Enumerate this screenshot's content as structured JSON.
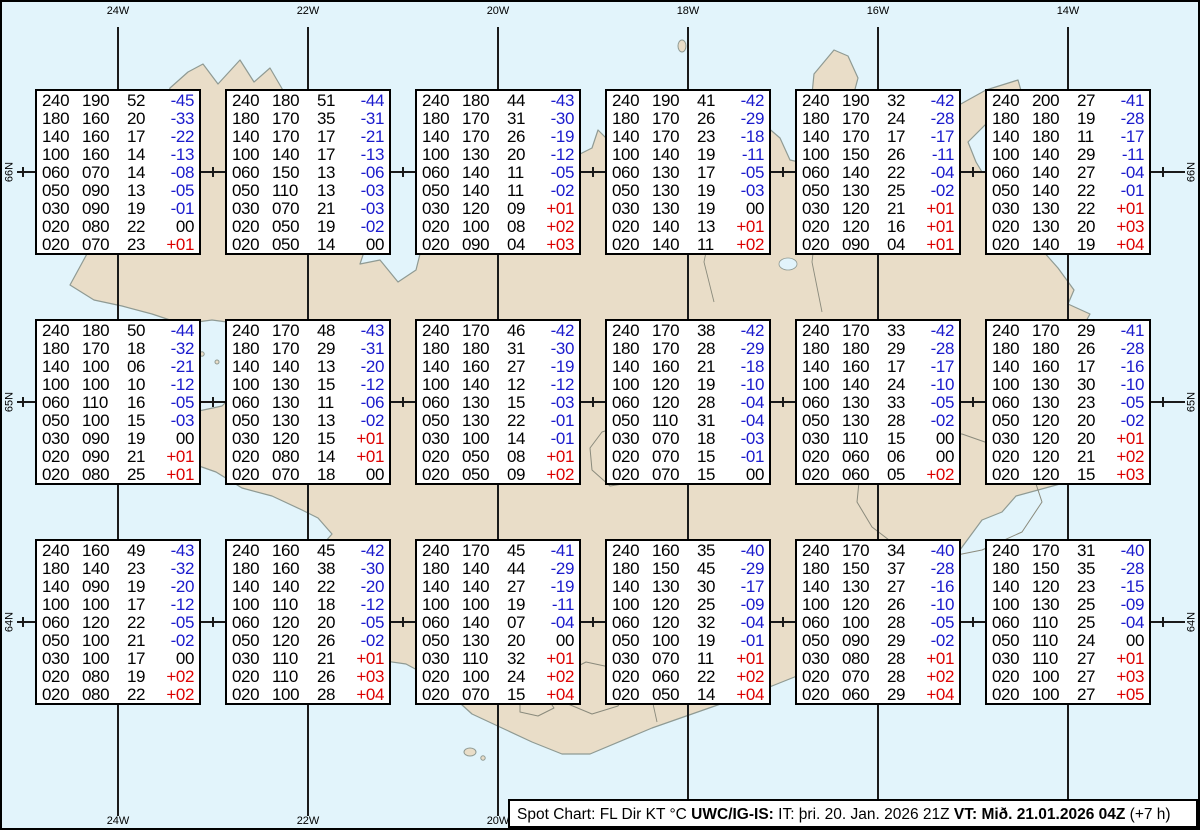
{
  "colors": {
    "ocean": "#E2F4FB",
    "land": "#E9DDC8",
    "coast": "#8F9A93",
    "grid_line": "#1A1A1A",
    "temp_negative": "#1A1ACD",
    "temp_positive": "#DD0000",
    "temp_zero": "#000000"
  },
  "map": {
    "lon_labels_top": [
      "24W",
      "22W",
      "20W",
      "18W",
      "16W",
      "14W"
    ],
    "lon_labels_bottom": [
      "24W",
      "22W",
      "20W"
    ],
    "lat_labels_left": [
      "66N",
      "65N",
      "64N"
    ],
    "lat_labels_right": [
      "66N",
      "65N",
      "64N"
    ]
  },
  "footer": {
    "segments": [
      {
        "text": "Spot Chart: FL Dir KT °C ",
        "bold": false
      },
      {
        "text": "UWC/IG-IS:",
        "bold": true
      },
      {
        "text": " IT: þri. 20. Jan. 2026 21Z ",
        "bold": false
      },
      {
        "text": "VT: Mið. 21.01.2026 04Z",
        "bold": true
      },
      {
        "text": " (+7 h)",
        "bold": false
      }
    ]
  },
  "chart_data": {
    "type": "table",
    "title": "Spot Chart: FL Dir KT °C",
    "columns": [
      "FL",
      "Dir",
      "KT",
      "°C"
    ],
    "grid_lons": [
      "24W",
      "22W",
      "20W",
      "18W",
      "16W",
      "14W"
    ],
    "grid_lats": [
      "66N",
      "65N",
      "64N"
    ],
    "stations": [
      {
        "lat": "66N",
        "lon": "24W",
        "levels": [
          [
            "240",
            "190",
            "52",
            "-45"
          ],
          [
            "180",
            "160",
            "20",
            "-33"
          ],
          [
            "140",
            "160",
            "17",
            "-22"
          ],
          [
            "100",
            "160",
            "14",
            "-13"
          ],
          [
            "060",
            "070",
            "14",
            "-08"
          ],
          [
            "050",
            "090",
            "13",
            "-05"
          ],
          [
            "030",
            "090",
            "19",
            "-01"
          ],
          [
            "020",
            "080",
            "22",
            "00"
          ],
          [
            "020",
            "070",
            "23",
            "+01"
          ]
        ]
      },
      {
        "lat": "66N",
        "lon": "22W",
        "levels": [
          [
            "240",
            "180",
            "51",
            "-44"
          ],
          [
            "180",
            "170",
            "35",
            "-31"
          ],
          [
            "140",
            "170",
            "17",
            "-21"
          ],
          [
            "100",
            "140",
            "17",
            "-13"
          ],
          [
            "060",
            "150",
            "13",
            "-06"
          ],
          [
            "050",
            "110",
            "13",
            "-03"
          ],
          [
            "030",
            "070",
            "21",
            "-03"
          ],
          [
            "020",
            "050",
            "19",
            "-02"
          ],
          [
            "020",
            "050",
            "14",
            "00"
          ]
        ]
      },
      {
        "lat": "66N",
        "lon": "20W",
        "levels": [
          [
            "240",
            "180",
            "44",
            "-43"
          ],
          [
            "180",
            "170",
            "31",
            "-30"
          ],
          [
            "140",
            "170",
            "26",
            "-19"
          ],
          [
            "100",
            "130",
            "20",
            "-12"
          ],
          [
            "060",
            "140",
            "11",
            "-05"
          ],
          [
            "050",
            "140",
            "11",
            "-02"
          ],
          [
            "030",
            "120",
            "09",
            "+01"
          ],
          [
            "020",
            "100",
            "08",
            "+02"
          ],
          [
            "020",
            "090",
            "04",
            "+03"
          ]
        ]
      },
      {
        "lat": "66N",
        "lon": "18W",
        "levels": [
          [
            "240",
            "190",
            "41",
            "-42"
          ],
          [
            "180",
            "170",
            "26",
            "-29"
          ],
          [
            "140",
            "170",
            "23",
            "-18"
          ],
          [
            "100",
            "140",
            "19",
            "-11"
          ],
          [
            "060",
            "130",
            "17",
            "-05"
          ],
          [
            "050",
            "130",
            "19",
            "-03"
          ],
          [
            "030",
            "130",
            "19",
            "00"
          ],
          [
            "020",
            "140",
            "13",
            "+01"
          ],
          [
            "020",
            "140",
            "11",
            "+02"
          ]
        ]
      },
      {
        "lat": "66N",
        "lon": "16W",
        "levels": [
          [
            "240",
            "190",
            "32",
            "-42"
          ],
          [
            "180",
            "170",
            "24",
            "-28"
          ],
          [
            "140",
            "170",
            "17",
            "-17"
          ],
          [
            "100",
            "150",
            "26",
            "-11"
          ],
          [
            "060",
            "140",
            "22",
            "-04"
          ],
          [
            "050",
            "130",
            "25",
            "-02"
          ],
          [
            "030",
            "120",
            "21",
            "+01"
          ],
          [
            "020",
            "120",
            "16",
            "+01"
          ],
          [
            "020",
            "090",
            "04",
            "+01"
          ]
        ]
      },
      {
        "lat": "66N",
        "lon": "14W",
        "levels": [
          [
            "240",
            "200",
            "27",
            "-41"
          ],
          [
            "180",
            "180",
            "19",
            "-28"
          ],
          [
            "140",
            "180",
            "11",
            "-17"
          ],
          [
            "100",
            "140",
            "29",
            "-11"
          ],
          [
            "060",
            "140",
            "27",
            "-04"
          ],
          [
            "050",
            "140",
            "22",
            "-01"
          ],
          [
            "030",
            "130",
            "22",
            "+01"
          ],
          [
            "020",
            "130",
            "20",
            "+03"
          ],
          [
            "020",
            "140",
            "19",
            "+04"
          ]
        ]
      },
      {
        "lat": "65N",
        "lon": "24W",
        "levels": [
          [
            "240",
            "180",
            "50",
            "-44"
          ],
          [
            "180",
            "170",
            "18",
            "-32"
          ],
          [
            "140",
            "100",
            "06",
            "-21"
          ],
          [
            "100",
            "100",
            "10",
            "-12"
          ],
          [
            "060",
            "110",
            "16",
            "-05"
          ],
          [
            "050",
            "100",
            "15",
            "-03"
          ],
          [
            "030",
            "090",
            "19",
            "00"
          ],
          [
            "020",
            "090",
            "21",
            "+01"
          ],
          [
            "020",
            "080",
            "25",
            "+01"
          ]
        ]
      },
      {
        "lat": "65N",
        "lon": "22W",
        "levels": [
          [
            "240",
            "170",
            "48",
            "-43"
          ],
          [
            "180",
            "170",
            "29",
            "-31"
          ],
          [
            "140",
            "140",
            "13",
            "-20"
          ],
          [
            "100",
            "130",
            "15",
            "-12"
          ],
          [
            "060",
            "130",
            "11",
            "-06"
          ],
          [
            "050",
            "130",
            "13",
            "-02"
          ],
          [
            "030",
            "120",
            "15",
            "+01"
          ],
          [
            "020",
            "080",
            "14",
            "+01"
          ],
          [
            "020",
            "070",
            "18",
            "00"
          ]
        ]
      },
      {
        "lat": "65N",
        "lon": "20W",
        "levels": [
          [
            "240",
            "170",
            "46",
            "-42"
          ],
          [
            "180",
            "180",
            "31",
            "-30"
          ],
          [
            "140",
            "160",
            "27",
            "-19"
          ],
          [
            "100",
            "140",
            "12",
            "-12"
          ],
          [
            "060",
            "130",
            "15",
            "-03"
          ],
          [
            "050",
            "130",
            "22",
            "-01"
          ],
          [
            "030",
            "100",
            "14",
            "-01"
          ],
          [
            "020",
            "050",
            "08",
            "+01"
          ],
          [
            "020",
            "050",
            "09",
            "+02"
          ]
        ]
      },
      {
        "lat": "65N",
        "lon": "18W",
        "levels": [
          [
            "240",
            "170",
            "38",
            "-42"
          ],
          [
            "180",
            "170",
            "28",
            "-29"
          ],
          [
            "140",
            "160",
            "21",
            "-18"
          ],
          [
            "100",
            "120",
            "19",
            "-10"
          ],
          [
            "060",
            "120",
            "28",
            "-04"
          ],
          [
            "050",
            "110",
            "31",
            "-04"
          ],
          [
            "030",
            "070",
            "18",
            "-03"
          ],
          [
            "020",
            "070",
            "15",
            "-01"
          ],
          [
            "020",
            "070",
            "15",
            "00"
          ]
        ]
      },
      {
        "lat": "65N",
        "lon": "16W",
        "levels": [
          [
            "240",
            "170",
            "33",
            "-42"
          ],
          [
            "180",
            "180",
            "29",
            "-28"
          ],
          [
            "140",
            "160",
            "17",
            "-17"
          ],
          [
            "100",
            "140",
            "24",
            "-10"
          ],
          [
            "060",
            "130",
            "33",
            "-05"
          ],
          [
            "050",
            "130",
            "28",
            "-02"
          ],
          [
            "030",
            "110",
            "15",
            "00"
          ],
          [
            "020",
            "060",
            "06",
            "00"
          ],
          [
            "020",
            "060",
            "05",
            "+02"
          ]
        ]
      },
      {
        "lat": "65N",
        "lon": "14W",
        "levels": [
          [
            "240",
            "170",
            "29",
            "-41"
          ],
          [
            "180",
            "180",
            "26",
            "-28"
          ],
          [
            "140",
            "160",
            "17",
            "-16"
          ],
          [
            "100",
            "130",
            "30",
            "-10"
          ],
          [
            "060",
            "130",
            "23",
            "-05"
          ],
          [
            "050",
            "120",
            "20",
            "-02"
          ],
          [
            "030",
            "120",
            "20",
            "+01"
          ],
          [
            "020",
            "120",
            "21",
            "+02"
          ],
          [
            "020",
            "120",
            "15",
            "+03"
          ]
        ]
      },
      {
        "lat": "64N",
        "lon": "24W",
        "levels": [
          [
            "240",
            "160",
            "49",
            "-43"
          ],
          [
            "180",
            "140",
            "23",
            "-32"
          ],
          [
            "140",
            "090",
            "19",
            "-20"
          ],
          [
            "100",
            "100",
            "17",
            "-12"
          ],
          [
            "060",
            "120",
            "22",
            "-05"
          ],
          [
            "050",
            "100",
            "21",
            "-02"
          ],
          [
            "030",
            "100",
            "17",
            "00"
          ],
          [
            "020",
            "080",
            "19",
            "+02"
          ],
          [
            "020",
            "080",
            "22",
            "+02"
          ]
        ]
      },
      {
        "lat": "64N",
        "lon": "22W",
        "levels": [
          [
            "240",
            "160",
            "45",
            "-42"
          ],
          [
            "180",
            "160",
            "38",
            "-30"
          ],
          [
            "140",
            "140",
            "22",
            "-20"
          ],
          [
            "100",
            "110",
            "18",
            "-12"
          ],
          [
            "060",
            "120",
            "20",
            "-05"
          ],
          [
            "050",
            "120",
            "26",
            "-02"
          ],
          [
            "030",
            "110",
            "21",
            "+01"
          ],
          [
            "020",
            "110",
            "26",
            "+03"
          ],
          [
            "020",
            "100",
            "28",
            "+04"
          ]
        ]
      },
      {
        "lat": "64N",
        "lon": "20W",
        "levels": [
          [
            "240",
            "170",
            "45",
            "-41"
          ],
          [
            "180",
            "140",
            "44",
            "-29"
          ],
          [
            "140",
            "140",
            "27",
            "-19"
          ],
          [
            "100",
            "100",
            "19",
            "-11"
          ],
          [
            "060",
            "140",
            "07",
            "-04"
          ],
          [
            "050",
            "130",
            "20",
            "00"
          ],
          [
            "030",
            "110",
            "32",
            "+01"
          ],
          [
            "020",
            "100",
            "24",
            "+02"
          ],
          [
            "020",
            "070",
            "15",
            "+04"
          ]
        ]
      },
      {
        "lat": "64N",
        "lon": "18W",
        "levels": [
          [
            "240",
            "160",
            "35",
            "-40"
          ],
          [
            "180",
            "150",
            "45",
            "-29"
          ],
          [
            "140",
            "130",
            "30",
            "-17"
          ],
          [
            "100",
            "120",
            "25",
            "-09"
          ],
          [
            "060",
            "120",
            "32",
            "-04"
          ],
          [
            "050",
            "100",
            "19",
            "-01"
          ],
          [
            "030",
            "070",
            "11",
            "+01"
          ],
          [
            "020",
            "060",
            "22",
            "+02"
          ],
          [
            "020",
            "050",
            "14",
            "+04"
          ]
        ]
      },
      {
        "lat": "64N",
        "lon": "16W",
        "levels": [
          [
            "240",
            "170",
            "34",
            "-40"
          ],
          [
            "180",
            "150",
            "37",
            "-28"
          ],
          [
            "140",
            "130",
            "27",
            "-16"
          ],
          [
            "100",
            "120",
            "26",
            "-10"
          ],
          [
            "060",
            "100",
            "28",
            "-05"
          ],
          [
            "050",
            "090",
            "29",
            "-02"
          ],
          [
            "030",
            "080",
            "28",
            "+01"
          ],
          [
            "020",
            "070",
            "28",
            "+02"
          ],
          [
            "020",
            "060",
            "29",
            "+04"
          ]
        ]
      },
      {
        "lat": "64N",
        "lon": "14W",
        "levels": [
          [
            "240",
            "170",
            "31",
            "-40"
          ],
          [
            "180",
            "150",
            "35",
            "-28"
          ],
          [
            "140",
            "120",
            "23",
            "-15"
          ],
          [
            "100",
            "130",
            "25",
            "-09"
          ],
          [
            "060",
            "110",
            "25",
            "-04"
          ],
          [
            "050",
            "110",
            "24",
            "00"
          ],
          [
            "030",
            "110",
            "27",
            "+01"
          ],
          [
            "020",
            "100",
            "27",
            "+03"
          ],
          [
            "020",
            "100",
            "27",
            "+05"
          ]
        ]
      }
    ]
  }
}
